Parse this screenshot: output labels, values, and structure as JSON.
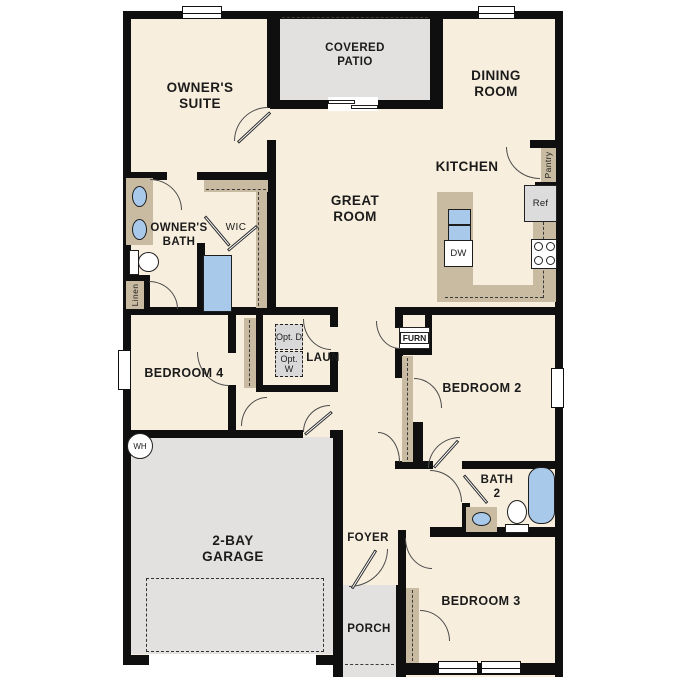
{
  "plan_type": "single-story floor plan",
  "palette": {
    "floor": "#f7eedd",
    "wall": "#0f0f0f",
    "concrete": "#e2e1df",
    "counter_tan": "#c9bba2",
    "fixture_blue": "#a9c9ea",
    "option_gray": "#d9d9d9"
  },
  "labels": {
    "owners_suite": "OWNER'S SUITE",
    "covered_patio": "COVERED PATIO",
    "dining_room": "DINING ROOM",
    "kitchen": "KITCHEN",
    "great_room": "GREAT ROOM",
    "owners_bath": "OWNER'S BATH",
    "wic": "WIC",
    "linen": "Linen",
    "pantry": "Pantry",
    "ref": "Ref",
    "dw": "DW",
    "bedroom4": "BEDROOM 4",
    "laundry": "LAUN",
    "opt_d": "Opt. D",
    "opt_w": "Opt. W",
    "furn": "FURN",
    "bedroom2": "BEDROOM 2",
    "bath2": "BATH 2",
    "foyer": "FOYER",
    "garage": "2-BAY GARAGE",
    "water_heater": "WH",
    "porch": "PORCH",
    "bedroom3": "BEDROOM 3"
  }
}
